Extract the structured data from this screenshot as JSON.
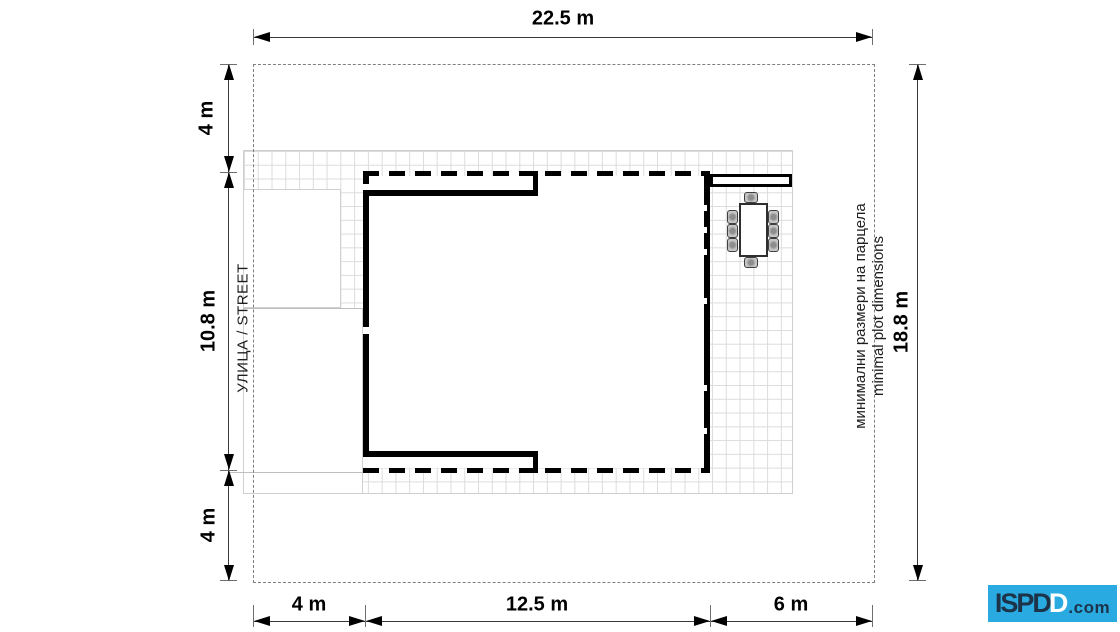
{
  "plot": {
    "total_width": "22.5 m",
    "total_height": "18.8 m",
    "left_setbacks": [
      "4 m",
      "10.8 m",
      "4 m"
    ],
    "bottom_setbacks": [
      "4 m",
      "12.5 m",
      "6 m"
    ]
  },
  "dims": {
    "top": "22.5 m",
    "right": "18.8 m",
    "left": [
      "4 m",
      "10.8 m",
      "4 m"
    ],
    "bottom": [
      "4 m",
      "12.5 m",
      "6 m"
    ]
  },
  "labels": {
    "street": "УЛИЦА / STREET",
    "note_line1": "минимални размери на парцела",
    "note_line2": "minimal plot dimensions"
  },
  "logo": {
    "prefix": "ISPD",
    "highlight": "D",
    "suffix": ".com"
  },
  "colors": {
    "logo_bg": "#29ABE2",
    "logo_ink": "#1C3349",
    "logo_highlight": "#FFFFFF",
    "grid_line": "#DCDCDC",
    "boundary_gray": "#7F7F7F",
    "ink": "#000000"
  }
}
